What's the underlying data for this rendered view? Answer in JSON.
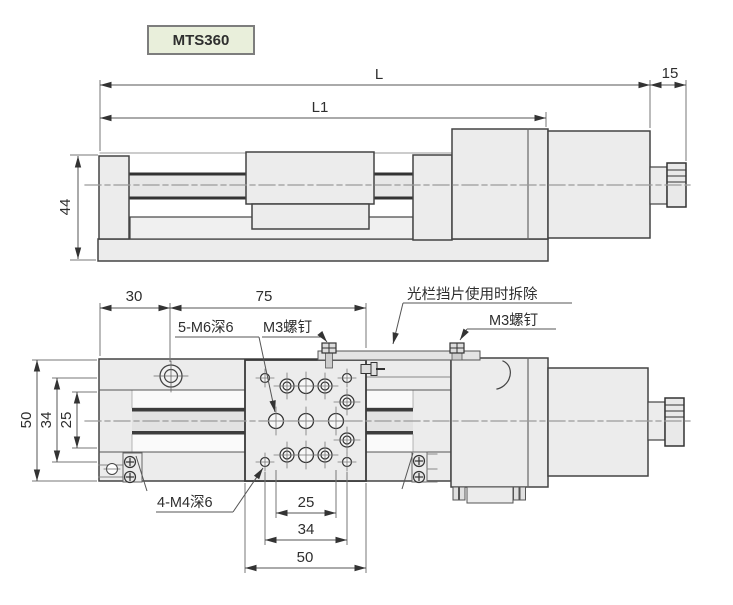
{
  "badge": {
    "label": "MTS360"
  },
  "top_view": {
    "dim_L": "L",
    "dim_L1": "L1",
    "dim_15": "15",
    "dim_44": "44"
  },
  "bottom_view": {
    "dim_30": "30",
    "dim_75": "75",
    "dim_50_left": "50",
    "dim_34_left": "34",
    "dim_25_left": "25",
    "dim_25_bottom": "25",
    "dim_34_bottom": "34",
    "dim_50_bottom": "50",
    "label_m6_holes": "5-M6深6",
    "label_m3_screw_left": "M3螺钉",
    "label_shutter": "光栏挡片使用时拆除",
    "label_m3_screw_right": "M3螺钉",
    "label_m4_holes": "4-M4深6"
  }
}
